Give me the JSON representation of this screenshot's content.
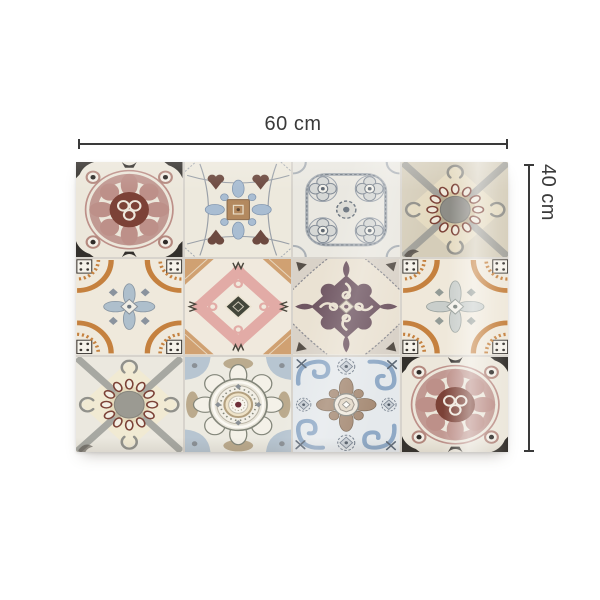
{
  "scene": {
    "background": "#ffffff",
    "width_label": "60 cm",
    "height_label": "40 cm"
  },
  "panel": {
    "columns": 4,
    "rows": 3,
    "description": "patchwork panel of 12 vintage azulejo-style patterned tiles with glossy sheen",
    "tiles": [
      {
        "name": "rose rosette tile with black corner leaves and eye dots",
        "symbol": "#sym-rose-rosette"
      },
      {
        "name": "cream floral tile with tan centre square, blue lace and brown tulips",
        "symbol": "#sym-cream-floral"
      },
      {
        "name": "grey quatrefoil medallion tile",
        "symbol": "#sym-gray-quatrefoil"
      },
      {
        "name": "tan tile with grey diagonal cross and chain ring of ovals",
        "symbol": "#sym-ring-chain-dark"
      },
      {
        "name": "cream tile with orange corner fans, dotted squares and blue cross",
        "symbol": "#sym-orange-fan-blue"
      },
      {
        "name": "pink damask tile with dark centre diamond and terracotta corners",
        "symbol": "#sym-pink-damask"
      },
      {
        "name": "plum baroque medallion tile with lacy grey corners",
        "symbol": "#sym-plum-baroque"
      },
      {
        "name": "cream tile with orange corner fans, dotted squares and grey cross",
        "symbol": "#sym-orange-fan-gray"
      },
      {
        "name": "light tile with grey diagonal cross and chain ring of ovals",
        "symbol": "#sym-ring-chain-light"
      },
      {
        "name": "circular mandala medallion tile with maroon centre dot",
        "symbol": "#sym-mandala"
      },
      {
        "name": "pale blue scroll tile with taupe centre ornament",
        "symbol": "#sym-blue-scroll"
      },
      {
        "name": "rose rosette tile with black corner leaves and eye dots",
        "symbol": "#sym-rose-rosette"
      }
    ]
  },
  "palette": {
    "dim": "#3a3a3a",
    "grout": "#d7d3cc",
    "cream": "#ece7db",
    "ink": "#33302c",
    "rose": "#bd9089",
    "maroon": "#7c4237",
    "lblue": "#a9bdd2",
    "brown": "#6d4a40",
    "tan": "#b3895f",
    "orange": "#c5813f",
    "fanblue": "#aebfcc",
    "fangray": "#c9cecb",
    "pink": "#e2aba6",
    "terra": "#cd9a66",
    "darkolive": "#43463a",
    "plum": "#6f5662",
    "sage": "#83867a",
    "sand": "#b3a07f",
    "wine": "#6e2f38",
    "steel": "#8fa9c6",
    "taupe": "#a68b75",
    "lblue2": "#b7c5d1"
  }
}
